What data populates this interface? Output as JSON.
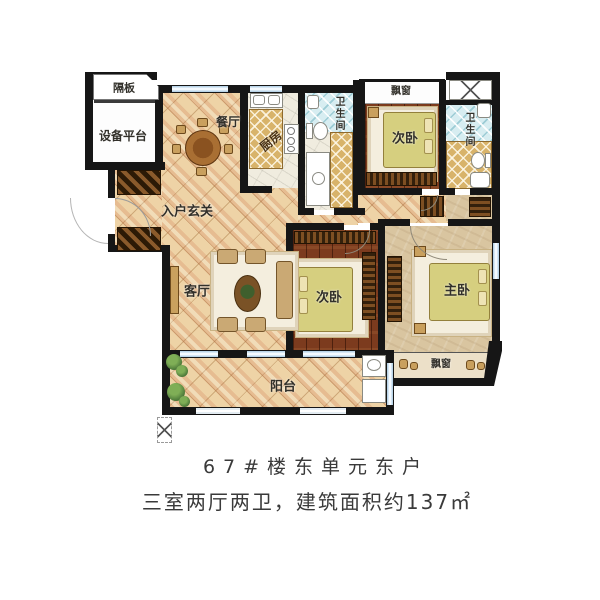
{
  "plan": {
    "labels": {
      "partition": "隔板",
      "equipment_platform": "设备平台",
      "dining": "餐厅",
      "kitchen": "厨房",
      "bathroom_1": "卫生间",
      "bathroom_2": "卫生间",
      "bay_window_top": "飘窗",
      "bay_window_bottom": "飘窗",
      "bedroom_top": "次卧",
      "bedroom_middle": "次卧",
      "master_bedroom": "主卧",
      "entry_hall": "入户玄关",
      "living_room": "客厅",
      "balcony": "阳台"
    },
    "colors": {
      "wall": "#161616",
      "tile_floor": "#eed3a6",
      "wood_floor": "#7c3b1e",
      "master_floor": "#d9c5a0",
      "bath_tile": "#d7edf1",
      "gold_tile": "#d8b36a",
      "bed": "#d6cf7f",
      "window": "#b9d4e8"
    }
  },
  "caption": {
    "line1": "67#楼东单元东户",
    "line2": "三室两厅两卫，建筑面积约137㎡"
  }
}
